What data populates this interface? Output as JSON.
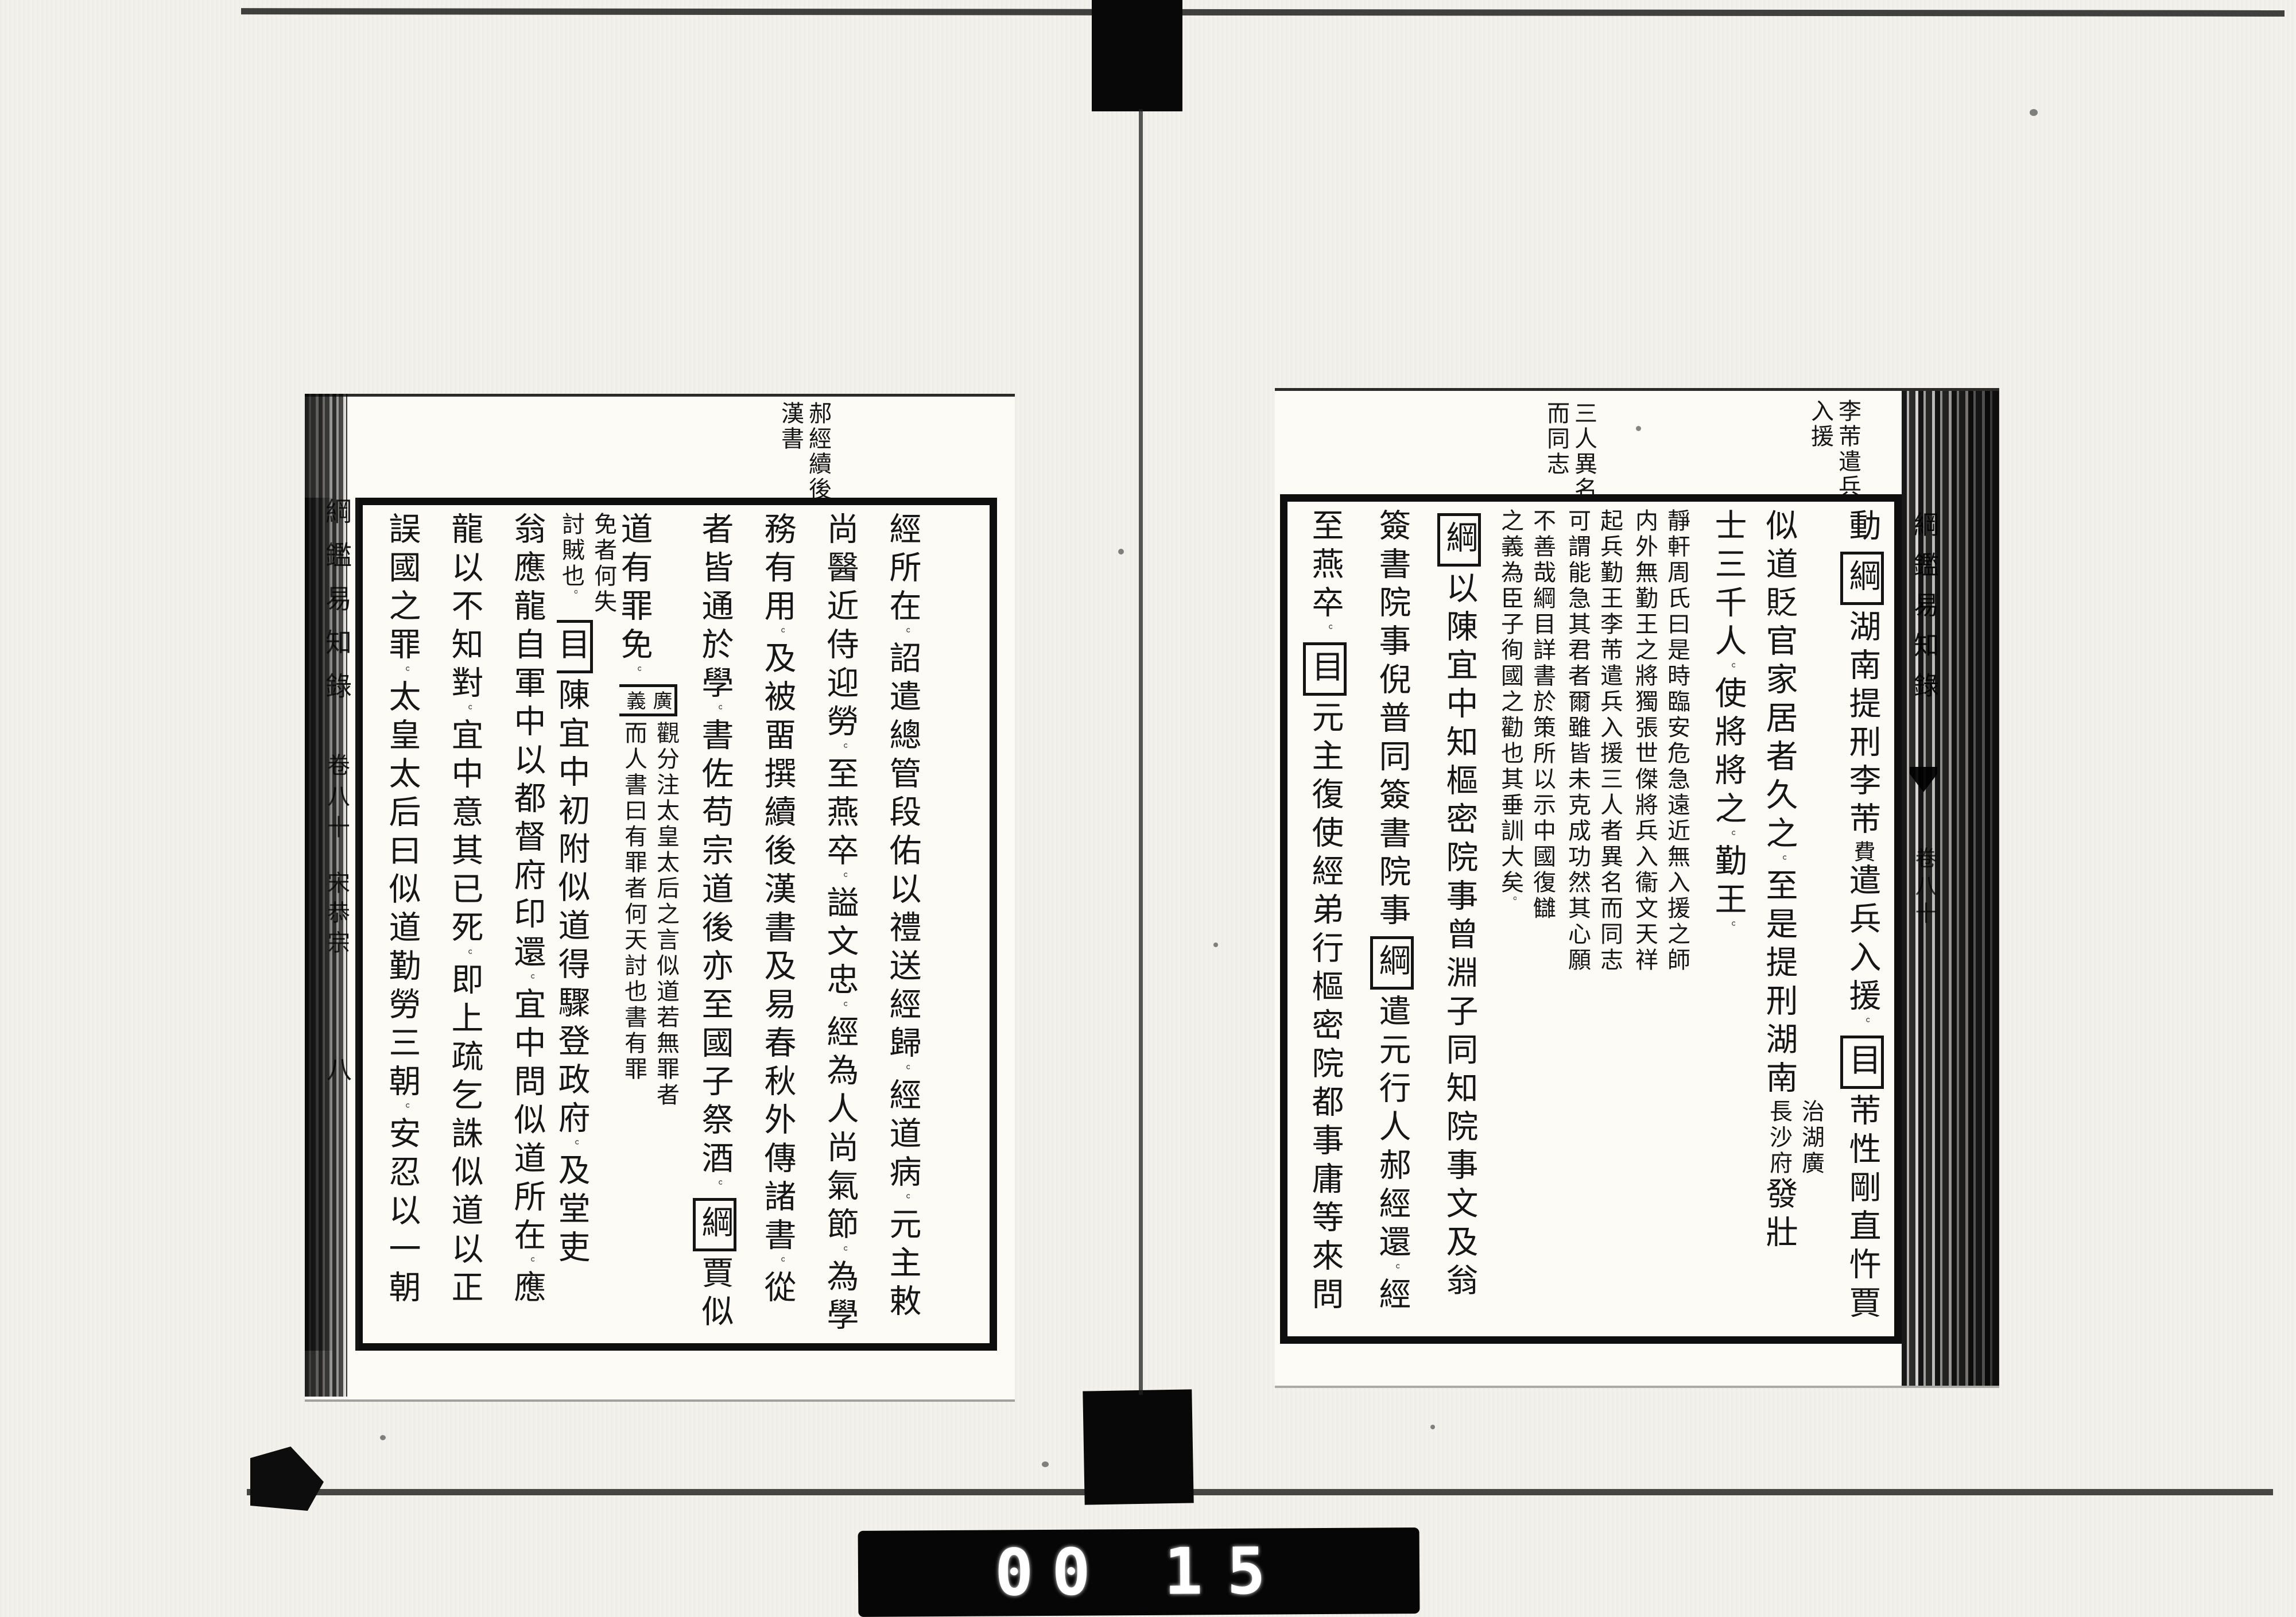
{
  "film": {
    "counter": {
      "digits": [
        "0",
        "0",
        "1",
        "5"
      ]
    }
  },
  "right_page": {
    "margin_notes": [
      {
        "lines": [
          "李芾遣兵",
          "入援"
        ]
      },
      {
        "lines": [
          "三人異名",
          "而同志"
        ]
      }
    ],
    "spine_partial": {
      "title": "綱鑑易知錄",
      "chapter": "卷八十"
    },
    "columns": [
      [
        {
          "k": "t",
          "v": "動"
        },
        {
          "k": "box",
          "v": "綱"
        },
        {
          "k": "t",
          "v": "湖南提刑李芾"
        },
        {
          "k": "sm",
          "v": "費"
        },
        {
          "k": "t",
          "v": "遣兵入援。"
        },
        {
          "k": "box",
          "v": "目"
        },
        {
          "k": "t",
          "v": "芾性剛直忤賈"
        }
      ],
      [
        {
          "k": "t",
          "v": "似道貶官家居者久之。至是提刑湖南"
        },
        {
          "k": "pair",
          "r": "治湖廣",
          "l": "長沙府"
        },
        {
          "k": "t",
          "v": "發壯"
        }
      ],
      [
        {
          "k": "t",
          "v": "士三千人。使將將之。勤王。"
        }
      ],
      [
        {
          "k": "pair",
          "r": "靜軒周氏曰是時臨安危急遠近無入援之師",
          "l": "内外無勤王之將獨張世傑將兵入衞文天祥"
        }
      ],
      [
        {
          "k": "pair",
          "r": "起兵勤王李芾遣兵入援三人者異名而同志",
          "l": "可謂能急其君者爾雖皆未克成功然其心願"
        }
      ],
      [
        {
          "k": "pair",
          "r": "不善哉綱目詳書於策所以示中國復讎",
          "l": "之義為臣子徇國之勸也其垂訓大矣。"
        }
      ],
      [
        {
          "k": "box",
          "v": "綱"
        },
        {
          "k": "t",
          "v": "以陳宜中知樞密院事曾淵子同知院事文及翁"
        }
      ],
      [
        {
          "k": "t",
          "v": "簽書院事倪普同簽書院事"
        },
        {
          "k": "box",
          "v": "綱"
        },
        {
          "k": "t",
          "v": "遣元行人郝經還。經"
        }
      ],
      [
        {
          "k": "t",
          "v": "至燕卒。"
        },
        {
          "k": "box",
          "v": "目"
        },
        {
          "k": "t",
          "v": "元主復使經弟行樞密院都事庸等來問"
        }
      ]
    ]
  },
  "left_page": {
    "margin_notes": [
      {
        "lines": [
          "郝經續後",
          "漢書"
        ]
      }
    ],
    "spine": {
      "title": "綱鑑易知錄",
      "chapter": "卷八十",
      "section": "宋恭宗",
      "page_number": "八"
    },
    "columns": [
      [
        {
          "k": "t",
          "v": "經所在。詔遣總管段佑以禮送經歸。經道病。元主敕"
        }
      ],
      [
        {
          "k": "t",
          "v": "尚醫近侍迎勞。至燕卒。謚文忠。經為人尚氣節。為學"
        }
      ],
      [
        {
          "k": "t",
          "v": "務有用。及被畱撰續後漢書及易春秋外傳諸書。從"
        }
      ],
      [
        {
          "k": "t",
          "v": "者皆通於學。書佐苟宗道後亦至國子祭酒。"
        },
        {
          "k": "box",
          "v": "綱"
        },
        {
          "k": "t",
          "v": "賈似"
        }
      ],
      [
        {
          "k": "t",
          "v": "道有罪免。"
        },
        {
          "k": "box2",
          "v": [
            "廣",
            "義"
          ]
        },
        {
          "k": "pair",
          "r": "觀分注太皇太后之言似道若無罪者",
          "l": "而人書曰有罪者何天討也書有罪"
        }
      ],
      [
        {
          "k": "pair",
          "r": "免者何失",
          "l": "討賊也。"
        },
        {
          "k": "box",
          "v": "目"
        },
        {
          "k": "t",
          "v": "陳宜中初附似道得驟登政府。及堂吏"
        }
      ],
      [
        {
          "k": "t",
          "v": "翁應龍自軍中以都督府印還。宜中問似道所在。應"
        }
      ],
      [
        {
          "k": "t",
          "v": "龍以不知對。宜中意其已死。即上疏乞誅似道以正"
        }
      ],
      [
        {
          "k": "t",
          "v": "誤國之罪。太皇太后曰似道勤勞三朝。安忍以一朝"
        }
      ]
    ]
  }
}
